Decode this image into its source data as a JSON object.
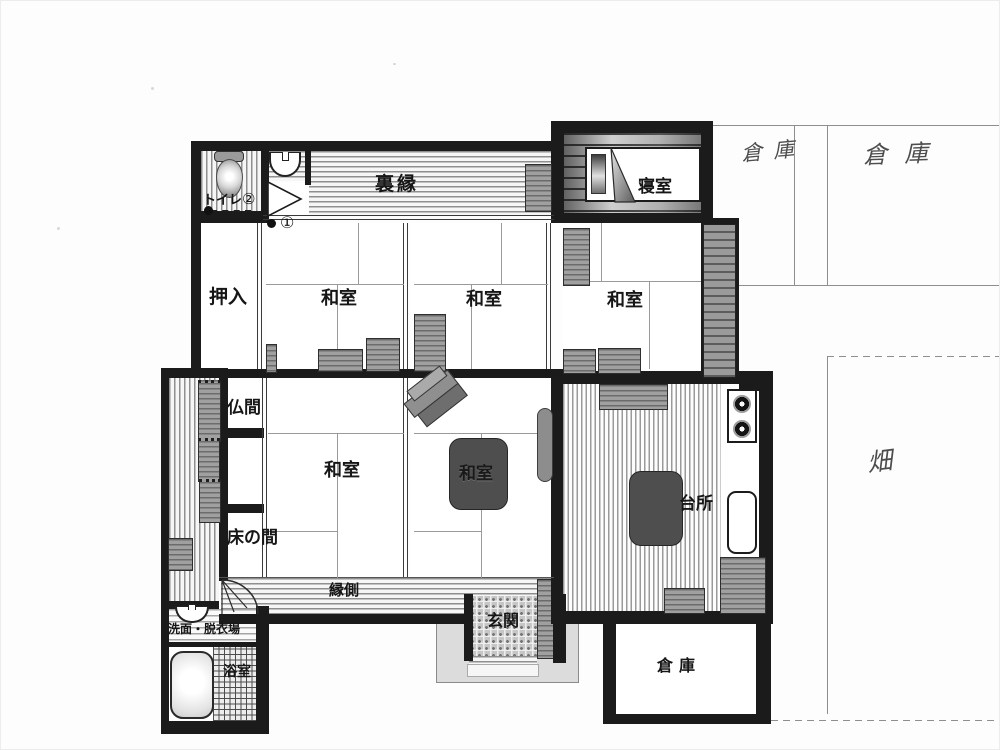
{
  "rooms": {
    "rear_veranda": {
      "label": "裏縁"
    },
    "bedroom": {
      "label": "寝室"
    },
    "toilet": {
      "label": "トイレ",
      "marker": "②"
    },
    "hall_marker": {
      "label": "①"
    },
    "closet": {
      "label": "押入"
    },
    "japanese_room": {
      "label": "和室"
    },
    "butsuma": {
      "label": "仏間"
    },
    "tokonoma": {
      "label": "床の間"
    },
    "kitchen": {
      "label": "台所"
    },
    "veranda": {
      "label": "縁側"
    },
    "entrance": {
      "label": "玄関"
    },
    "washroom": {
      "label": "洗面・脱衣場"
    },
    "bathroom": {
      "label": "浴室"
    },
    "storage_room": {
      "label": "倉庫"
    }
  },
  "handwritten": {
    "storage_left": "倉庫",
    "storage_right": "倉庫",
    "field": "畑"
  },
  "colors": {
    "wall": "#1b1b1b",
    "stripe": "#8f8f8f",
    "furniture_gray": "#a0a0a0",
    "dark_table": "#4e4e4e",
    "pencil": "#8e8e8e"
  }
}
